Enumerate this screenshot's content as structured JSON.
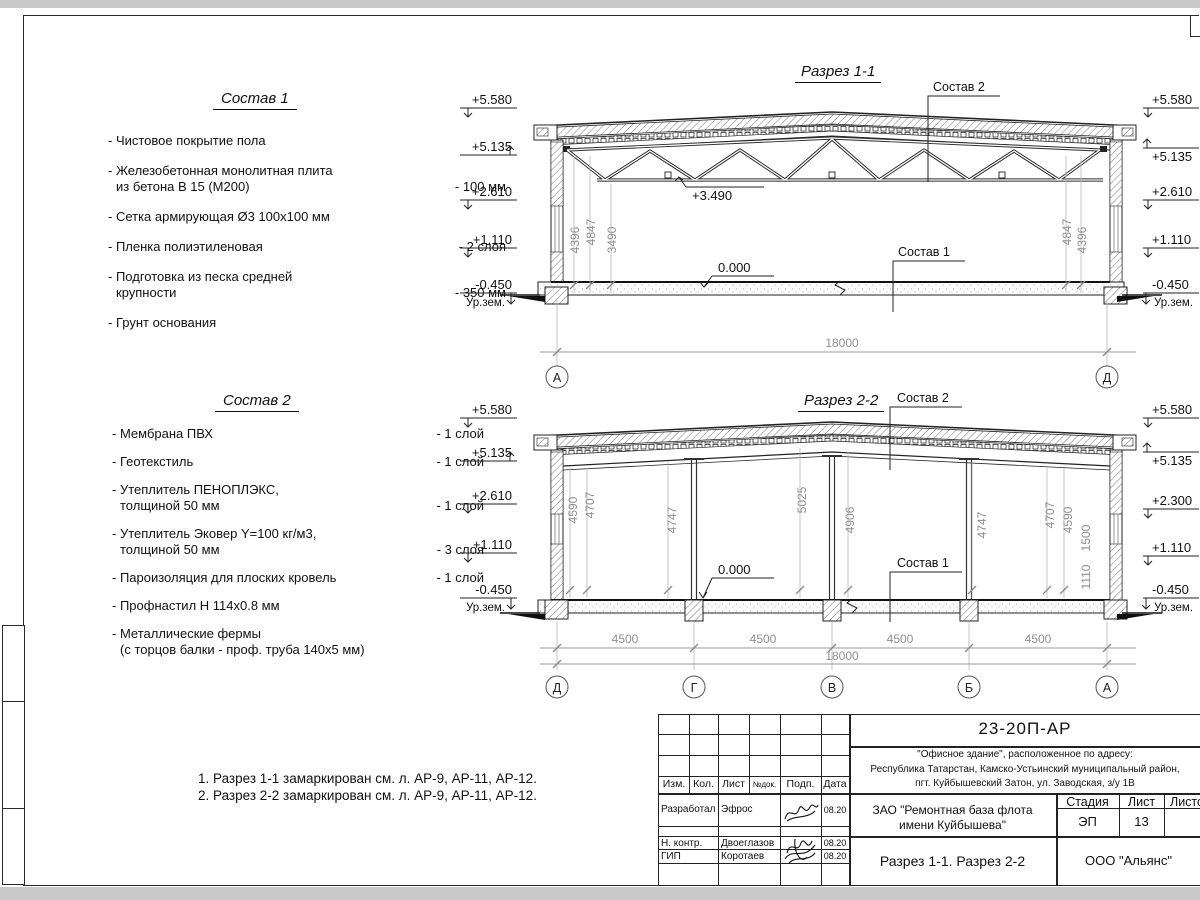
{
  "colors": {
    "ink": "#1a1a1a",
    "dim_text": "#8f8f8f",
    "paper": "#ffffff"
  },
  "page": {
    "notes": [
      "1. Разрез 1-1 замаркирован см. л. АР-9, АР-11, АР-12.",
      "2. Разрез 2-2 замаркирован см. л. АР-9, АР-11, АР-12."
    ]
  },
  "sostav1": {
    "title": "Состав 1",
    "items": [
      {
        "l1": "- Чистовое покрытие пола"
      },
      {
        "l1": "- Железобетонная  монолитная плита",
        "l2": "из бетона В 15 (М200)",
        "v": "- 100 мм"
      },
      {
        "l1": "- Сетка армирующая Ø3 100х100 мм"
      },
      {
        "l1": "- Пленка полиэтиленовая",
        "v": "-  2 слоя"
      },
      {
        "l1": "- Подготовка из песка средней",
        "l2": "крупности",
        "v": "- 350 мм"
      },
      {
        "l1": "- Грунт основания"
      }
    ]
  },
  "sostav2": {
    "title": "Состав 2",
    "items": [
      {
        "l1": "- Мембрана ПВХ",
        "v": "- 1 слой"
      },
      {
        "l1": "- Геотекстиль",
        "v": "- 1 слой"
      },
      {
        "l1": "- Утеплитель ПЕНОПЛЭКС,",
        "l2": "толщиной 50 мм",
        "v": "- 1 слой"
      },
      {
        "l1": "- Утеплитель Эковер Y=100 кг/м3,",
        "l2": "толщиной 50 мм",
        "v": "- 3 слоя"
      },
      {
        "l1": "- Пароизоляция для плоских кровель",
        "v": "- 1 слой"
      },
      {
        "l1": "- Профнастил Н 114х0.8 мм"
      },
      {
        "l1": "- Металлические фермы",
        "l2": "(с торцов балки - проф. труба 140х5 мм)"
      }
    ]
  },
  "section1": {
    "title": "Разрез 1-1",
    "levels_left": [
      "+5.580",
      "+5.135",
      "+2.610",
      "+1.110",
      "-0.450"
    ],
    "levels_right": [
      "+5.580",
      "+5.135",
      "+2.610",
      "+1.110",
      "-0.450"
    ],
    "ground": "Ур.зем.",
    "dims_left": [
      "4396",
      "4847",
      "3490"
    ],
    "dims_right": [
      "4847",
      "4396"
    ],
    "truss_level": "+3.490",
    "floor_level": "0.000",
    "sostav2_label": "Состав 2",
    "sostav1_label": "Состав 1",
    "span": "18000",
    "axis_left": "А",
    "axis_right": "Д"
  },
  "section2": {
    "title": "Разрез 2-2",
    "levels_left": [
      "+5.580",
      "+5.135",
      "+2.610",
      "+1.110",
      "-0.450"
    ],
    "levels_right": [
      "+5.580",
      "+5.135",
      "+2.300",
      "+1.110",
      "-0.450"
    ],
    "ground": "Ур.зем.",
    "dims": [
      "4590",
      "4707",
      "4747",
      "5025",
      "4906",
      "4747",
      "4707",
      "4590",
      "1500",
      "1110"
    ],
    "floor_level": "0.000",
    "sostav2_label": "Состав 2",
    "sostav1_label": "Состав 1",
    "bottom_dims": [
      "4500",
      "4500",
      "4500",
      "4500"
    ],
    "total": "18000",
    "axes": [
      "Д",
      "Г",
      "В",
      "Б",
      "А"
    ]
  },
  "titleblock": {
    "code": "23-20П-АР",
    "address": [
      "\"Офисное здание\", расположенное по адресу:",
      "Республика Татарстан, Камско-Устьинский муниципальный район,",
      "пгт. Куйбышевский Затон, ул. Заводская, з/у 1В"
    ],
    "cols": [
      "Изм.",
      "Кол.",
      "Лист",
      "№док.",
      "Подп.",
      "Дата"
    ],
    "rows": [
      {
        "role": "Разработал",
        "name": "Эфрос",
        "date": "08.20"
      },
      {
        "role": "Н. контр.",
        "name": "Двоеглазов",
        "date": "08.20"
      },
      {
        "role": "ГИП",
        "name": "Коротаев",
        "date": "08.20"
      }
    ],
    "client": [
      "ЗАО \"Ремонтная база флота",
      "имени Куйбышева\""
    ],
    "stage_label": "Стадия",
    "sheet_label": "Лист",
    "sheets_label": "Листов",
    "stage": "ЭП",
    "sheet": "13",
    "doc_title": "Разрез 1-1. Разрез 2-2",
    "org": "ООО \"Альянс\""
  }
}
